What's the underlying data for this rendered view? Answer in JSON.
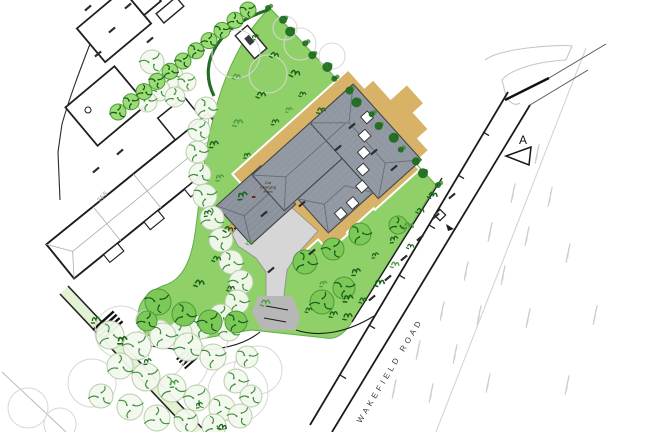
{
  "drawing": {
    "road_name": "WAKEFIELD ROAD",
    "section_marker": "A",
    "neighbor_house_number": "258",
    "car_charging_lines": [
      "Car",
      "Charging",
      "Point"
    ]
  },
  "colors": {
    "site_green": "#8fd168",
    "site_green_edge": "#62ad4a",
    "tree_dark_green": "#1a6418",
    "tree_bright_fill": "#7cc957",
    "tree_row_fill": "#9bdc74",
    "tree_light_fill": "#f4f9ef",
    "paving_tan": "#d8b266",
    "roof_gray": "#949aa4",
    "roof_line": "#676c75",
    "driveway_gray": "#d6d6d6",
    "tarmac_gray": "#b7b7b7",
    "line_black": "#1b1b1b",
    "faint_gray": "#cdcdcd"
  }
}
